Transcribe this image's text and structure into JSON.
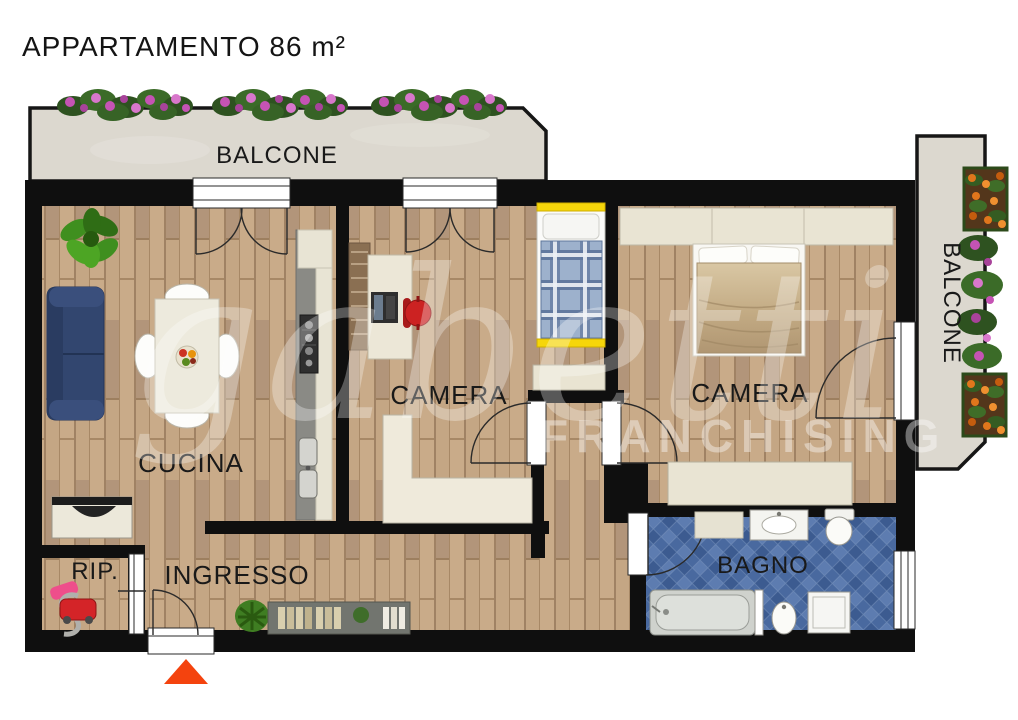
{
  "title": "APPARTAMENTO 86 m²",
  "rooms": {
    "balcone_top": "BALCONE",
    "balcone_right": "BALCONE",
    "cucina": "CUCINA",
    "camera_mid": "CAMERA",
    "camera_right": "CAMERA",
    "bagno": "BAGNO",
    "ingresso": "INGRESSO",
    "rip": "RIP."
  },
  "watermark": {
    "brand": "gabetti",
    "sub": "FRANCHISING"
  },
  "entrance_marker": {
    "icon": "triangle-up",
    "color": "#f4430e"
  },
  "colors": {
    "wall": "#0f0f0f",
    "wood_floor": "#bfa183",
    "balcony_floor": "#dcd8cf",
    "bath_tile": "#49699f",
    "sofa": "#32466f",
    "single_bed_plaid": "#8fa6c4",
    "single_bed_frame": "#f6d60a",
    "double_bed_blanket": "#c7b28e",
    "office_chair": "#cc2222",
    "flower_pink": "#c553b4",
    "flower_orange": "#e0761c",
    "watermark": "#ffffff"
  }
}
